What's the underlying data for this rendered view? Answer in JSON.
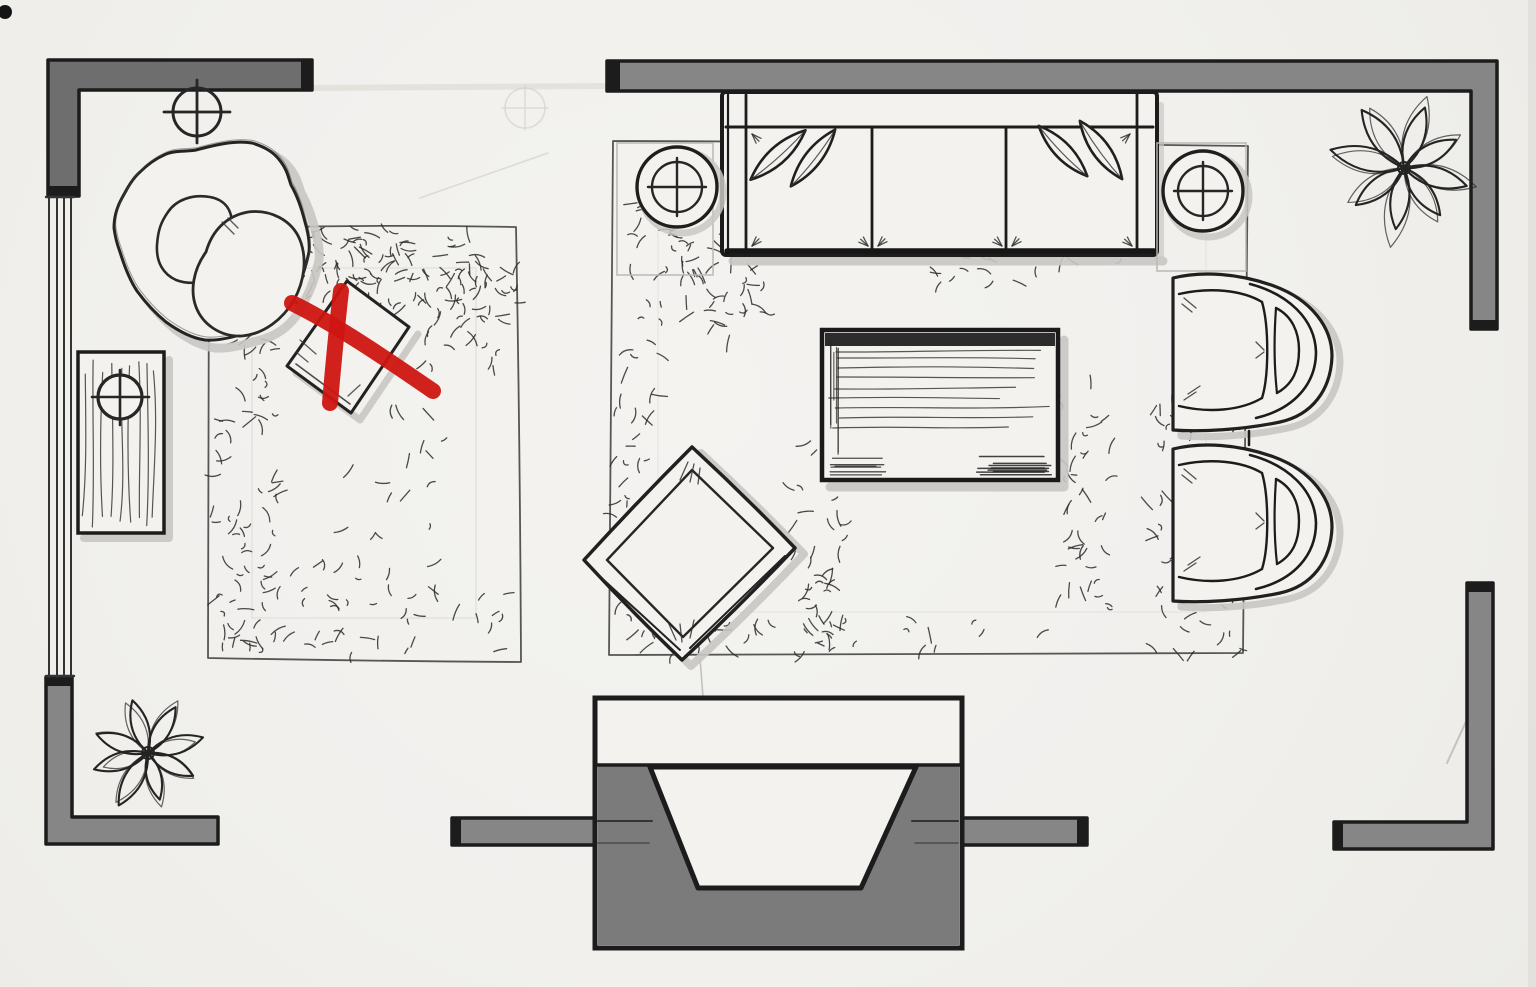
{
  "page": {
    "title": "Living room furniture floor plan",
    "medium": "hand-drawn marker and ink sketch on paper, top view",
    "annotation": {
      "type": "red-x-mark",
      "meaning": "crossed-out / rejected furniture placement",
      "target": "small square side table on the left rug",
      "color": "#cf1511"
    }
  },
  "palette": {
    "paper": "#f3f2ef",
    "ink": "#1c1c1c",
    "sketch": "#2b2b2b",
    "grain": "#3a3a3a",
    "pencil": "#b9b6b0",
    "pencil_faint": "#d8d5d0",
    "wall_fill": "#868686",
    "wall_fill_dark": "#6e6e6e",
    "fireplace_fill": "#7b7b7b",
    "shadow": "#c9c7c3",
    "red_x": "#cf1511"
  },
  "legend": {
    "circle_cross": "lamp / ceiling light symbol",
    "gray_bands": "walls",
    "parallel_line_strip": "window",
    "white_trapezoid_recess": "fireplace firebox",
    "scribbled_border_rectangles": "area rugs"
  },
  "items": [
    {
      "id": "lounge-chair",
      "desc": "organic curved swivel lounge chair with two cushions",
      "area": "top-left corner"
    },
    {
      "id": "ceiling-light",
      "desc": "circle-cross light symbol above lounge chair",
      "area": "top-left"
    },
    {
      "id": "side-table-wood",
      "desc": "rectangular wood-grain side table with lamp symbol",
      "area": "left wall"
    },
    {
      "id": "window-left",
      "desc": "window strip of four parallel lines",
      "area": "left wall"
    },
    {
      "id": "rug-left",
      "desc": "rectangular area rug with scribbled pile texture",
      "area": "left half"
    },
    {
      "id": "side-table-crossed",
      "desc": "small rotated square side table marked with a red X",
      "area": "on left rug"
    },
    {
      "id": "sofa",
      "desc": "three-cushion sofa with two leaf-shaped pillows at each end",
      "area": "against top wall"
    },
    {
      "id": "lamp-table-left",
      "desc": "round lamp table with circle-cross symbol",
      "area": "left of sofa"
    },
    {
      "id": "lamp-table-right",
      "desc": "round lamp table with circle-cross symbol",
      "area": "right of sofa"
    },
    {
      "id": "rug-main",
      "desc": "large rectangular area rug under seating group",
      "area": "center-right"
    },
    {
      "id": "coffee-table",
      "desc": "rectangular wood coffee table with grain strokes",
      "area": "center of main rug"
    },
    {
      "id": "ottoman-chair",
      "desc": "square lounge chair rotated 45 degrees",
      "area": "lower-left of main rug"
    },
    {
      "id": "armchair-1",
      "desc": "barrel armchair facing left",
      "area": "right edge of main rug, upper"
    },
    {
      "id": "armchair-2",
      "desc": "barrel armchair facing left",
      "area": "right edge of main rug, lower"
    },
    {
      "id": "fireplace",
      "desc": "projecting fireplace with white trapezoid firebox in bottom wall",
      "area": "bottom center"
    },
    {
      "id": "plant-top-right",
      "desc": "eight-petal potted plant",
      "area": "top-right corner"
    },
    {
      "id": "plant-bottom-left",
      "desc": "eight-petal potted plant",
      "area": "bottom-left corner"
    }
  ],
  "openings": [
    {
      "id": "top-opening",
      "desc": "gap in top wall between left and right wall segments"
    },
    {
      "id": "right-opening",
      "desc": "gap in right wall"
    },
    {
      "id": "bottom-opening",
      "desc": "door gap in bottom wall right of fireplace"
    }
  ]
}
